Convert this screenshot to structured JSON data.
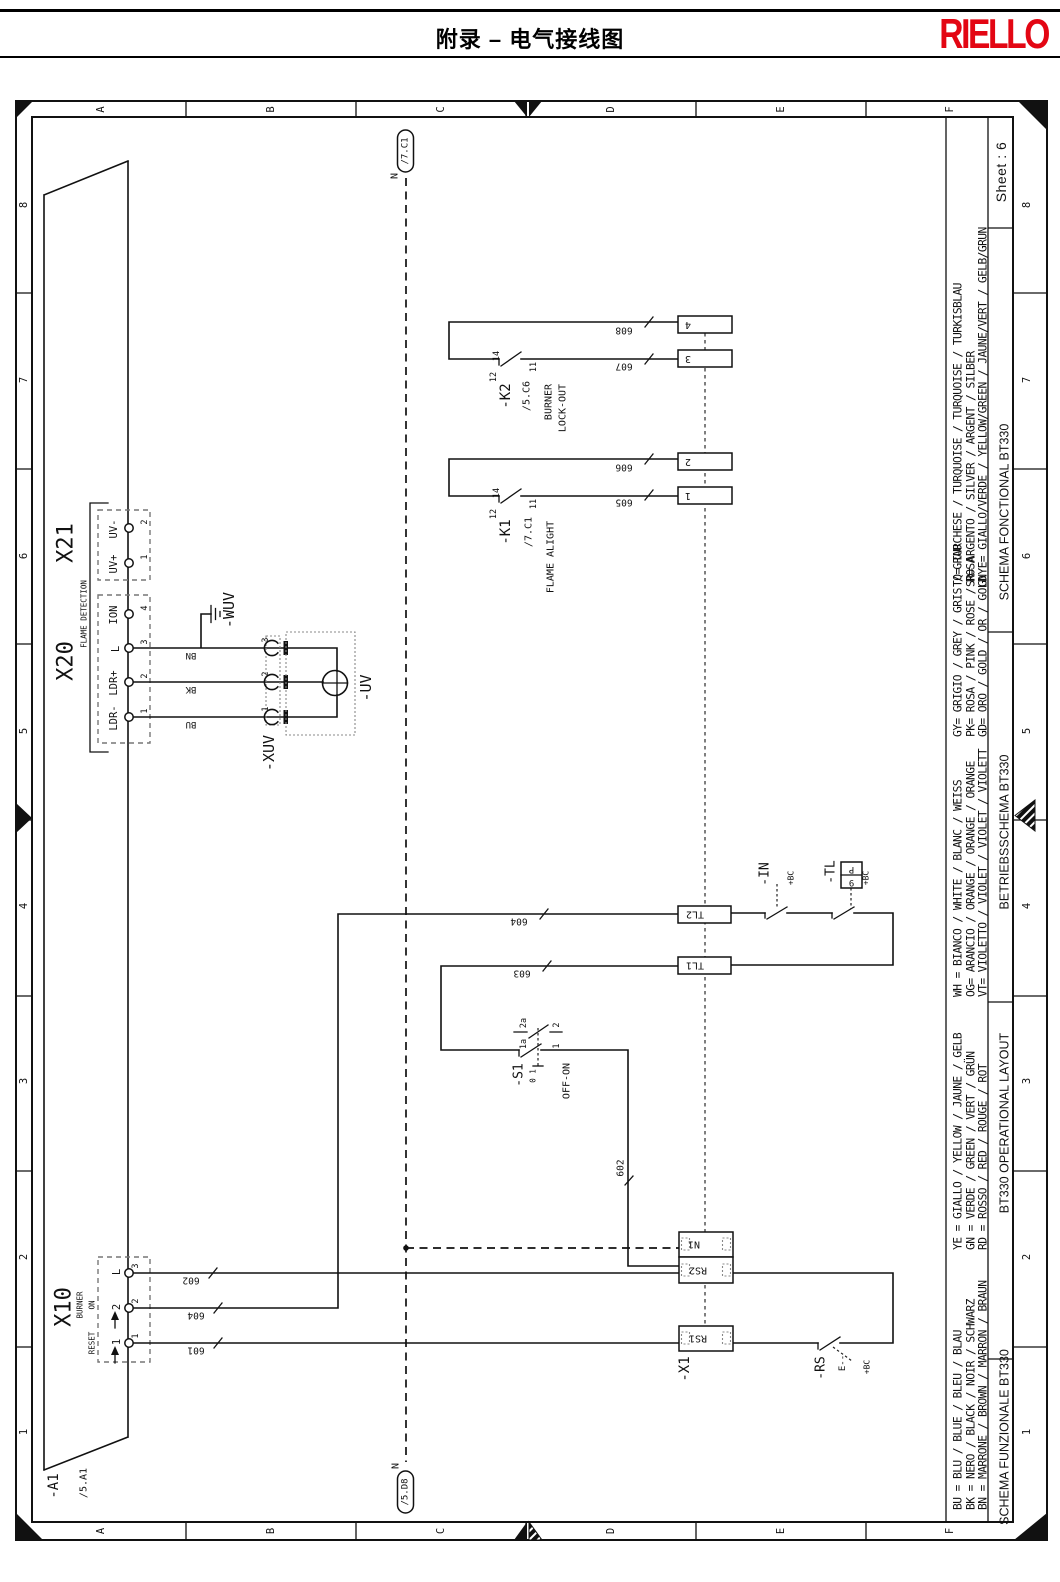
{
  "header": {
    "title": "附录 – 电气接线图",
    "brand": "RIELLO",
    "brand_color": "#e30613"
  },
  "frame": {
    "column_labels": [
      "A",
      "B",
      "C",
      "D",
      "E",
      "F"
    ],
    "row_labels": [
      "8",
      "7",
      "6",
      "5",
      "4",
      "3",
      "2",
      "1"
    ],
    "sheet_label": "Sheet : 6"
  },
  "legend": {
    "groups": [
      {
        "lines": [
          "TQ= TURCHESE / TURQUOISE / TURQUOISE / TURKISBLAU",
          "SR= ARGENTO / SILVER / ARGENT / SILBER",
          "GNYE= GIALLO/VERDE / YELLOW/GREEN / JAUNE/VERT / GELB/GRUN"
        ]
      },
      {
        "lines": [
          "GY= GRIGIO / GREY / GRIS / GRAU",
          "PK= ROSA / PINK / ROSE / ROSA",
          "GD= ORO / GOLD / OR / GOLD"
        ]
      },
      {
        "lines": [
          "WH = BIANCO / WHITE / BLANC / WEISS",
          "OG= ARANCIO / ORANGE / ORANGE / ORANGE",
          "VT= VIOLETTO / VIOLET / VIOLET / VIOLETT"
        ]
      },
      {
        "lines": [
          "YE = GIALLO / YELLOW / JAUNE / GELB",
          "GN = VERDE / GREEN / VERT / GRÜN",
          "RD = ROSSO / RED / ROUGE / ROT"
        ]
      },
      {
        "lines": [
          "BU = BLU / BLUE / BLEU / BLAU",
          "BK = NERO / BLACK / NOIR / SCHWARZ",
          "BN = MARRONE / BROWN / MARRON / BRAUN"
        ]
      }
    ],
    "titles": [
      "SCHEMA FONCTIONAL BT330",
      "BETRIEBSSCHEMA BT330",
      "BT330 OPERATIONAL LAYOUT",
      "SCHEMA FUNZIONALE BT330"
    ]
  },
  "schematic": {
    "labels": [
      {
        "name": "a1-ref",
        "text": "-A1",
        "x": 54,
        "y": 1486,
        "rot": -90,
        "size": 14
      },
      {
        "name": "a1-xref",
        "text": "/5.A1",
        "x": 84,
        "y": 1483,
        "rot": -90,
        "size": 10
      },
      {
        "name": "x21-label",
        "text": "X21",
        "x": 66,
        "y": 543,
        "rot": -90,
        "size": 22
      },
      {
        "name": "x20-label",
        "text": "X20",
        "x": 66,
        "y": 661,
        "rot": -90,
        "size": 22
      },
      {
        "name": "flame-detection-label",
        "text": "FLAME DETECTION",
        "x": 84,
        "y": 614,
        "rot": -90,
        "size": 7.5
      },
      {
        "name": "x21-uv-minus",
        "text": "UV-",
        "x": 114,
        "y": 529,
        "rot": -90,
        "size": 10.5
      },
      {
        "name": "x21-uv-plus",
        "text": "UV+",
        "x": 114,
        "y": 564,
        "rot": -90,
        "size": 10.5
      },
      {
        "name": "x20-ion",
        "text": "ION",
        "x": 114,
        "y": 615,
        "rot": -90,
        "size": 10.5
      },
      {
        "name": "x20-l",
        "text": "L",
        "x": 116,
        "y": 649,
        "rot": -90,
        "size": 10.5
      },
      {
        "name": "x20-ldr-plus",
        "text": "LDR+",
        "x": 114,
        "y": 683,
        "rot": -90,
        "size": 10.5
      },
      {
        "name": "x20-ldr-minus",
        "text": "LDR-",
        "x": 114,
        "y": 718,
        "rot": -90,
        "size": 10.5
      },
      {
        "name": "x21-pin-2",
        "text": "2",
        "x": 145,
        "y": 522,
        "rot": -90,
        "size": 8.5
      },
      {
        "name": "x21-pin-1",
        "text": "1",
        "x": 145,
        "y": 557,
        "rot": -90,
        "size": 8.5
      },
      {
        "name": "x20-pin-4",
        "text": "4",
        "x": 145,
        "y": 608,
        "rot": -90,
        "size": 8.5
      },
      {
        "name": "x20-pin-3",
        "text": "3",
        "x": 145,
        "y": 642,
        "rot": -90,
        "size": 8.5
      },
      {
        "name": "x20-pin-2",
        "text": "2",
        "x": 145,
        "y": 676,
        "rot": -90,
        "size": 8.5
      },
      {
        "name": "x20-pin-1",
        "text": "1",
        "x": 145,
        "y": 711,
        "rot": -90,
        "size": 8.5
      },
      {
        "name": "x10-label",
        "text": "X10",
        "x": 64,
        "y": 1307,
        "rot": -90,
        "size": 22
      },
      {
        "name": "x10-burner",
        "text": "BURNER",
        "x": 80,
        "y": 1305,
        "rot": -90,
        "size": 7.5
      },
      {
        "name": "x10-on",
        "text": "ON",
        "x": 92,
        "y": 1305,
        "rot": -90,
        "size": 7.5
      },
      {
        "name": "x10-reset",
        "text": "RESET",
        "x": 92,
        "y": 1343,
        "rot": -90,
        "size": 7.5
      },
      {
        "name": "x10-l-label",
        "text": "L",
        "x": 117,
        "y": 1272,
        "rot": -90,
        "size": 10.5
      },
      {
        "name": "x10-2-label",
        "text": "2",
        "x": 117,
        "y": 1307,
        "rot": -90,
        "size": 10.5
      },
      {
        "name": "x10-1-label",
        "text": "1",
        "x": 117,
        "y": 1342,
        "rot": -90,
        "size": 10.5
      },
      {
        "name": "x10-pin-3",
        "text": "3",
        "x": 136,
        "y": 1266,
        "rot": -90,
        "size": 8.5
      },
      {
        "name": "x10-pin-2",
        "text": "2",
        "x": 136,
        "y": 1301,
        "rot": -90,
        "size": 8.5
      },
      {
        "name": "x10-pin-1",
        "text": "1",
        "x": 136,
        "y": 1336,
        "rot": -90,
        "size": 8.5
      },
      {
        "name": "wire-color-bn",
        "text": "BN",
        "x": 191,
        "y": 655,
        "rot": 180,
        "size": 9
      },
      {
        "name": "wire-color-bk",
        "text": "BK",
        "x": 191,
        "y": 689,
        "rot": 180,
        "size": 9
      },
      {
        "name": "wire-color-bu",
        "text": "BU",
        "x": 191,
        "y": 724,
        "rot": 180,
        "size": 9
      },
      {
        "name": "wuv-ref",
        "text": "-WUV",
        "x": 229,
        "y": 610,
        "rot": -90,
        "size": 15
      },
      {
        "name": "xuv-ref",
        "text": "-XUV",
        "x": 269,
        "y": 753,
        "rot": -90,
        "size": 15
      },
      {
        "name": "uv-ref",
        "text": "-UV",
        "x": 366,
        "y": 688,
        "rot": -90,
        "size": 15
      },
      {
        "name": "xuv-pin-3",
        "text": "3",
        "x": 266,
        "y": 640,
        "rot": -90,
        "size": 8.5
      },
      {
        "name": "xuv-pin-2",
        "text": "2",
        "x": 266,
        "y": 674,
        "rot": -90,
        "size": 8.5
      },
      {
        "name": "xuv-pin-1",
        "text": "1",
        "x": 266,
        "y": 709,
        "rot": -90,
        "size": 8.5
      },
      {
        "name": "k2-ref",
        "text": "-K2",
        "x": 506,
        "y": 396,
        "rot": -90,
        "size": 14
      },
      {
        "name": "k2-xref",
        "text": "/5.C6",
        "x": 527,
        "y": 396,
        "rot": -90,
        "size": 10
      },
      {
        "name": "k2-func-line1",
        "text": "BURNER",
        "x": 549,
        "y": 402,
        "rot": -90,
        "size": 10
      },
      {
        "name": "k2-func-line2",
        "text": "LOCK-OUT",
        "x": 563,
        "y": 408,
        "rot": -90,
        "size": 10
      },
      {
        "name": "k2-pin-14",
        "text": "14",
        "x": 497,
        "y": 356,
        "rot": -90,
        "size": 8.5
      },
      {
        "name": "k2-pin-12",
        "text": "12",
        "x": 494,
        "y": 377,
        "rot": -90,
        "size": 8.5
      },
      {
        "name": "k2-pin-11",
        "text": "11",
        "x": 534,
        "y": 367,
        "rot": -90,
        "size": 8.5
      },
      {
        "name": "k1-ref",
        "text": "-K1",
        "x": 506,
        "y": 532,
        "rot": -90,
        "size": 14
      },
      {
        "name": "k1-xref",
        "text": "/7.C1",
        "x": 529,
        "y": 532,
        "rot": -90,
        "size": 10
      },
      {
        "name": "k1-func",
        "text": "FLAME ALIGHT",
        "x": 551,
        "y": 557,
        "rot": -90,
        "size": 10
      },
      {
        "name": "k1-pin-14",
        "text": "14",
        "x": 497,
        "y": 493,
        "rot": -90,
        "size": 8.5
      },
      {
        "name": "k1-pin-12",
        "text": "12",
        "x": 494,
        "y": 514,
        "rot": -90,
        "size": 8.5
      },
      {
        "name": "k1-pin-11",
        "text": "11",
        "x": 534,
        "y": 504,
        "rot": -90,
        "size": 8.5
      },
      {
        "name": "wire-608",
        "text": "608",
        "x": 624,
        "y": 330,
        "rot": 180,
        "size": 9.5
      },
      {
        "name": "wire-607",
        "text": "607",
        "x": 624,
        "y": 366,
        "rot": 180,
        "size": 9.5
      },
      {
        "name": "wire-606",
        "text": "606",
        "x": 624,
        "y": 467,
        "rot": 180,
        "size": 9.5
      },
      {
        "name": "wire-605",
        "text": "605",
        "x": 624,
        "y": 502,
        "rot": 180,
        "size": 9.5
      },
      {
        "name": "wire-604",
        "text": "604",
        "x": 519,
        "y": 921,
        "rot": 180,
        "size": 9.5
      },
      {
        "name": "wire-603",
        "text": "603",
        "x": 522,
        "y": 973,
        "rot": 180,
        "size": 9.5
      },
      {
        "name": "wire-602",
        "text": "602",
        "x": 191,
        "y": 1280,
        "rot": 180,
        "size": 9.5
      },
      {
        "name": "wire-604-b",
        "text": "604",
        "x": 196,
        "y": 1315,
        "rot": 180,
        "size": 9.5
      },
      {
        "name": "wire-601",
        "text": "601",
        "x": 196,
        "y": 1350,
        "rot": 180,
        "size": 9.5
      },
      {
        "name": "wire-602-vertical",
        "text": "602",
        "x": 621,
        "y": 1168,
        "rot": -90,
        "size": 9.5
      },
      {
        "name": "terminal-4",
        "text": "4",
        "x": 688,
        "y": 324.5,
        "rot": 180,
        "size": 10
      },
      {
        "name": "terminal-3",
        "text": "3",
        "x": 688,
        "y": 358.5,
        "rot": 180,
        "size": 10
      },
      {
        "name": "terminal-2",
        "text": "2",
        "x": 688,
        "y": 461.5,
        "rot": 180,
        "size": 10
      },
      {
        "name": "terminal-1",
        "text": "1",
        "x": 688,
        "y": 495.5,
        "rot": 180,
        "size": 10
      },
      {
        "name": "tl2-box-label",
        "text": "TL2",
        "x": 695,
        "y": 914,
        "rot": 180,
        "size": 10
      },
      {
        "name": "tl1-box-label",
        "text": "TL1",
        "x": 695,
        "y": 965,
        "rot": 180,
        "size": 10
      },
      {
        "name": "n1-box-label",
        "text": "N1",
        "x": 694,
        "y": 1244,
        "rot": 180,
        "size": 10
      },
      {
        "name": "rs2-box-label",
        "text": "RS2",
        "x": 698,
        "y": 1270,
        "rot": 180,
        "size": 10
      },
      {
        "name": "rs1-box-label",
        "text": "RS1",
        "x": 698,
        "y": 1338,
        "rot": 180,
        "size": 10
      },
      {
        "name": "s1-ref",
        "text": "-S1",
        "x": 519,
        "y": 1075,
        "rot": -90,
        "size": 13
      },
      {
        "name": "s1-pin-2a",
        "text": "2a",
        "x": 524,
        "y": 1023,
        "rot": -90,
        "size": 8.5
      },
      {
        "name": "s1-pin-1a",
        "text": "1a",
        "x": 524,
        "y": 1044,
        "rot": -90,
        "size": 8.5
      },
      {
        "name": "s1-pin-2",
        "text": "2",
        "x": 557,
        "y": 1025,
        "rot": -90,
        "size": 8.5
      },
      {
        "name": "s1-pin-1",
        "text": "1",
        "x": 557,
        "y": 1046,
        "rot": -90,
        "size": 8.5
      },
      {
        "name": "s1-positions",
        "text": "0 1",
        "x": 533,
        "y": 1076,
        "rot": -90,
        "size": 7.5
      },
      {
        "name": "s1-func",
        "text": "OFF-ON",
        "x": 567,
        "y": 1081,
        "rot": -90,
        "size": 10
      },
      {
        "name": "in-ref",
        "text": "-IN",
        "x": 765,
        "y": 874,
        "rot": -90,
        "size": 13
      },
      {
        "name": "in-bc",
        "text": "+BC",
        "x": 791,
        "y": 878,
        "rot": -90,
        "size": 8
      },
      {
        "name": "tl-ref",
        "text": "-TL",
        "x": 831,
        "y": 872,
        "rot": -90,
        "size": 13
      },
      {
        "name": "tl-bc",
        "text": "+BC",
        "x": 866,
        "y": 878,
        "rot": -90,
        "size": 8
      },
      {
        "name": "tl-9p-p",
        "text": "P",
        "x": 851.5,
        "y": 869,
        "rot": 180,
        "size": 9
      },
      {
        "name": "tl-9p-9",
        "text": "9",
        "x": 851.5,
        "y": 882,
        "rot": 180,
        "size": 9
      },
      {
        "name": "x1-ref",
        "text": "-X1",
        "x": 685,
        "y": 1369,
        "rot": -90,
        "size": 14
      },
      {
        "name": "rs-ref",
        "text": "-RS",
        "x": 821,
        "y": 1368,
        "rot": -90,
        "size": 13
      },
      {
        "name": "rs-e",
        "text": "E--",
        "x": 843,
        "y": 1363,
        "rot": -90,
        "size": 9
      },
      {
        "name": "rs-bc",
        "text": "+BC",
        "x": 867,
        "y": 1367,
        "rot": -90,
        "size": 8
      },
      {
        "name": "n-top-label",
        "text": "N",
        "x": 395,
        "y": 176,
        "rot": -90,
        "size": 10
      },
      {
        "name": "n-top-xref",
        "text": "/7.C1",
        "x": 405.5,
        "y": 151,
        "rot": -90,
        "size": 9
      },
      {
        "name": "n-bottom-label",
        "text": "N",
        "x": 396,
        "y": 1466,
        "rot": -90,
        "size": 10
      },
      {
        "name": "n-bottom-xref",
        "text": "/5.D8",
        "x": 405.5,
        "y": 1492,
        "rot": -90,
        "size": 9
      }
    ]
  }
}
